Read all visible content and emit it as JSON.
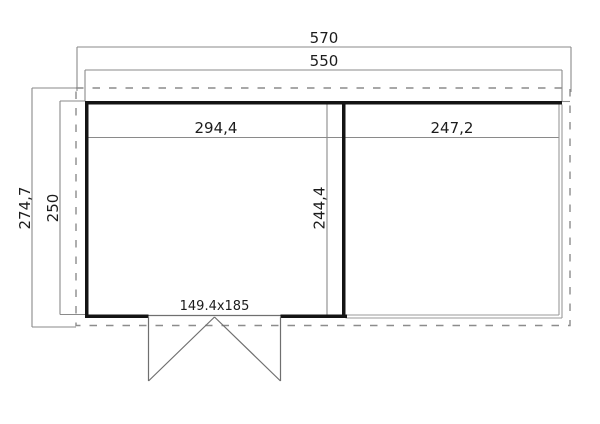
{
  "drawing": {
    "type": "floor-plan",
    "labels": {
      "overall_width": "570",
      "outer_wall_width": "550",
      "overall_depth": "274,7",
      "outer_wall_depth": "250",
      "left_room_inner_width": "294,4",
      "right_room_inner_width": "247,2",
      "room_inner_depth": "244,4",
      "door_dimensions": "149.4x185"
    },
    "colors": {
      "background": "#ffffff",
      "wall": "#141414",
      "dimension_line": "#8a8a8a",
      "roof_outline": "#8c8c8c",
      "veranda_edge": "#999999",
      "door_line": "#6f6f6f",
      "text": "#1c1c1c"
    }
  }
}
